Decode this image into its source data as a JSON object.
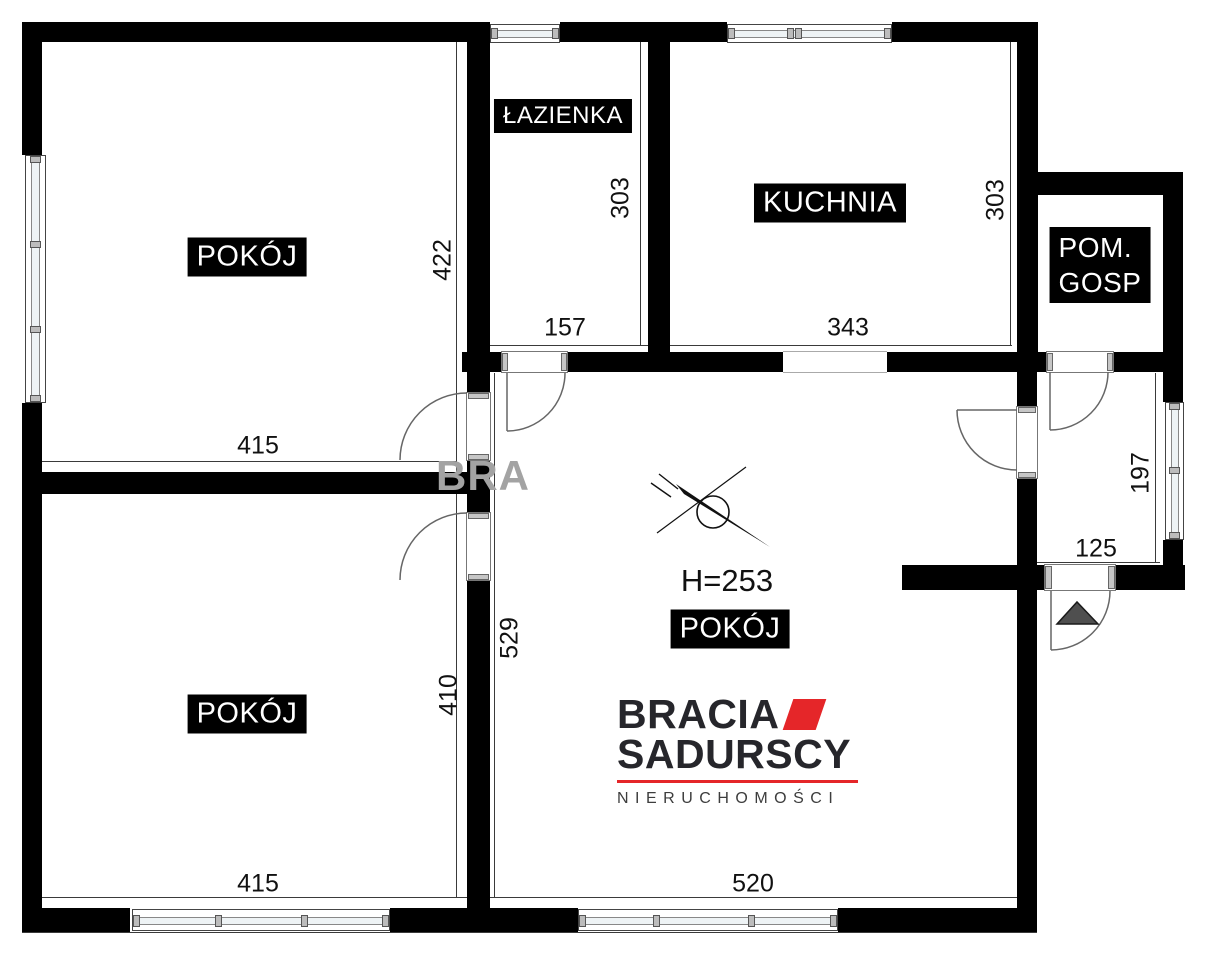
{
  "rooms": {
    "room_top_left": {
      "label": "POKÓJ",
      "width": "415",
      "height": "422"
    },
    "bathroom": {
      "label": "ŁAZIENKA",
      "width": "157",
      "height": "303"
    },
    "kitchen": {
      "label": "KUCHNIA",
      "width": "343",
      "height": "303"
    },
    "utility_room": {
      "label_line1": "POM.",
      "label_line2": "GOSP"
    },
    "room_bottom_left": {
      "label": "POKÓJ",
      "width": "415",
      "height": "410"
    },
    "room_center": {
      "label": "POKÓJ",
      "ceiling_height": "H=253",
      "width": "520",
      "height": "529"
    },
    "hallway": {
      "width": "125",
      "height": "197"
    }
  },
  "branding": {
    "logo_line1": "BRACIA",
    "logo_line2": "SADURSCY",
    "logo_line3": "NIERUCHOMOŚCI",
    "accent_color": "#e52629",
    "watermark": "BRA"
  },
  "colors": {
    "wall": "#000000",
    "background": "#ffffff",
    "glass": "#eef3f5",
    "label_bg": "#000000",
    "label_text": "#ffffff",
    "dimension_text": "#111111",
    "watermark_gray": "#a3a3a3",
    "entrance_marker": "#4f4f4f"
  }
}
